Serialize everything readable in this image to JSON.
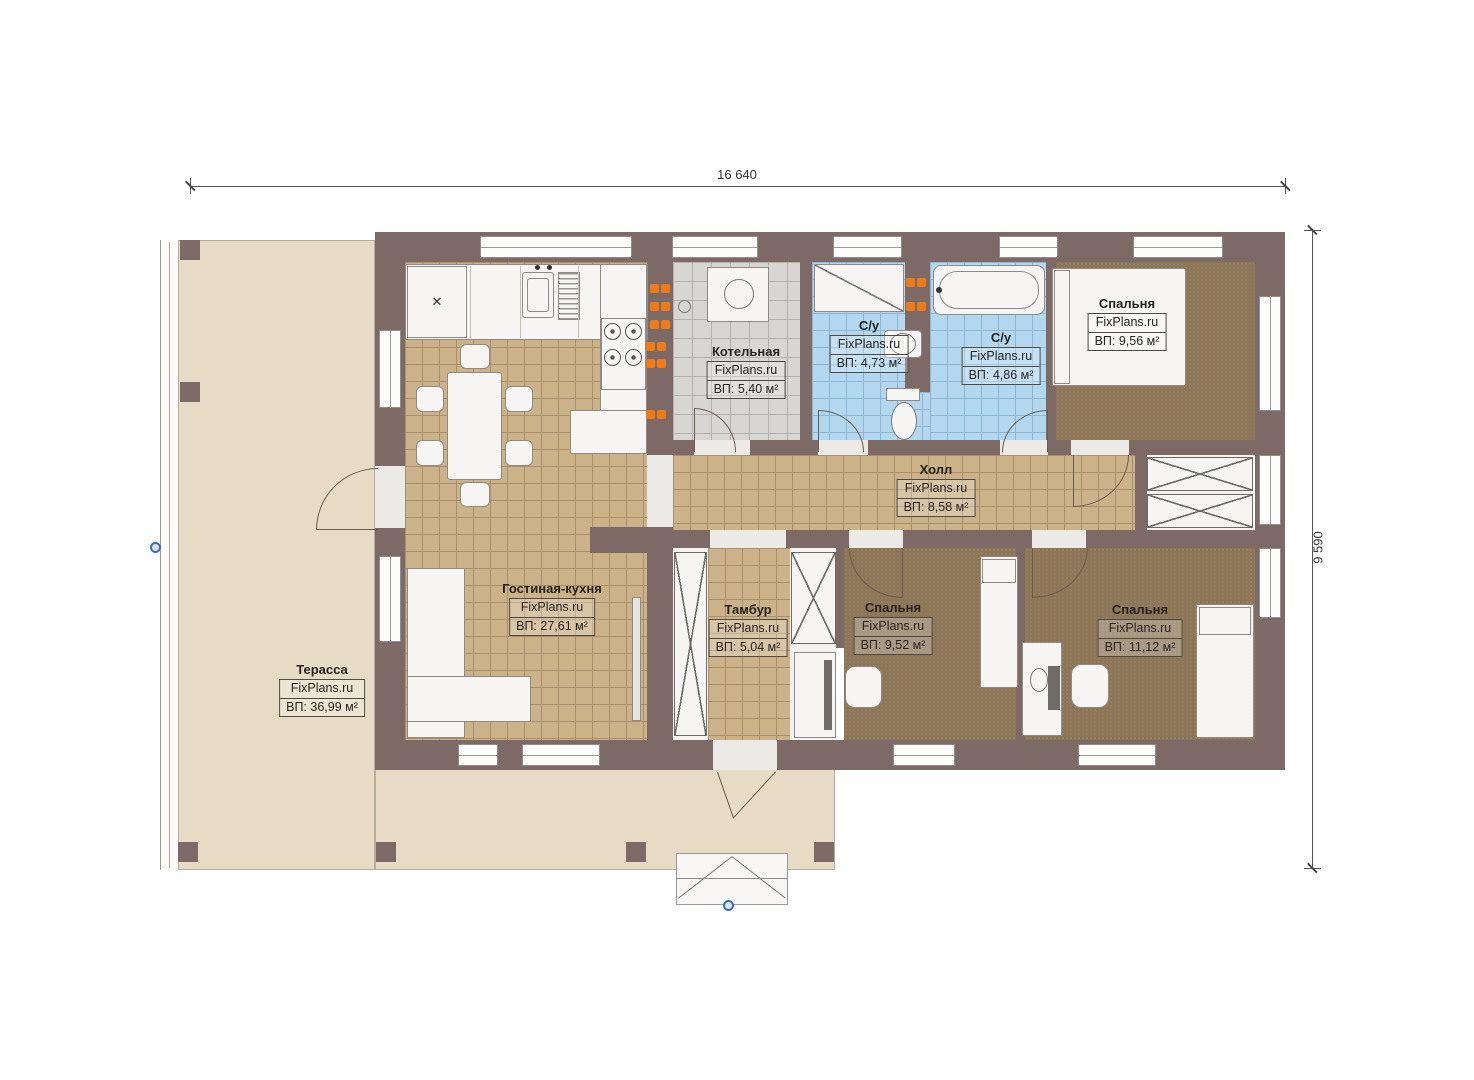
{
  "dimensions": {
    "width_label": "16 640",
    "height_label": "9 590"
  },
  "watermark": "FixPlans.ru",
  "rooms": {
    "terrace": {
      "name": "Терасса",
      "area": "ВП: 36,99 м²"
    },
    "living_kitchen": {
      "name": "Гостиная-кухня",
      "area": "ВП: 27,61 м²"
    },
    "boiler": {
      "name": "Котельная",
      "area": "ВП: 5,40 м²"
    },
    "bathroom_1": {
      "name": "С/у",
      "area": "ВП: 4,73 м²"
    },
    "bathroom_2": {
      "name": "С/у",
      "area": "ВП: 4,86 м²"
    },
    "bedroom_top": {
      "name": "Спальня",
      "area": "ВП: 9,56 м²"
    },
    "hall": {
      "name": "Холл",
      "area": "ВП: 8,58 м²"
    },
    "tambour": {
      "name": "Тамбур",
      "area": "ВП: 5,04 м²"
    },
    "bedroom_middle": {
      "name": "Спальня",
      "area": "ВП: 9,52 м²"
    },
    "bedroom_right": {
      "name": "Спальня",
      "area": "ВП: 11,12 м²"
    }
  },
  "icons": {
    "fridge_mark": "✕"
  },
  "colors": {
    "wall": "#7d6a66",
    "floor_tan": "#cbb288",
    "floor_tan_line": "#a98f6d",
    "floor_gray": "#d7d6d4",
    "floor_gray_line": "#b3b1ae",
    "floor_blue": "#b4d7f0",
    "floor_blue_line": "#8db5d6",
    "carpet": "#8d7657",
    "terrace": "#e8dbc6",
    "outlet_orange": "#ee7b17",
    "marker_blue": "#3a6fb5"
  }
}
